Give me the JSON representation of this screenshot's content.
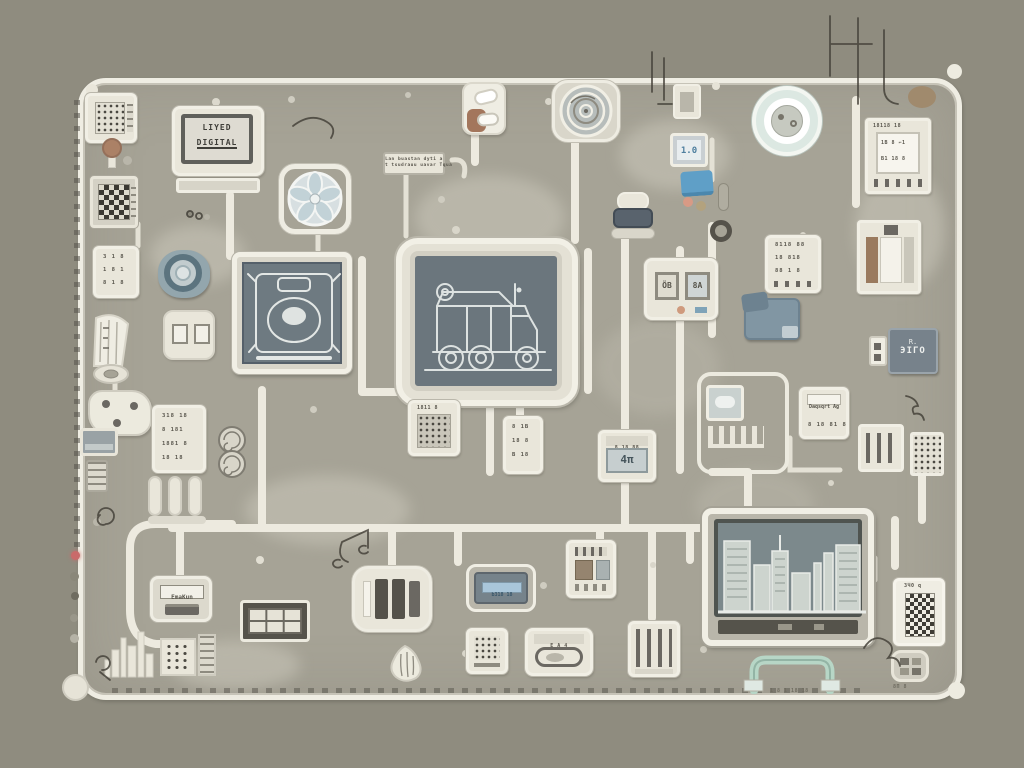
{
  "scene": {
    "title": "Stylized circuit board illustration with screens, chips and traces",
    "colors": {
      "background": "#8f8c7f",
      "board": "#a6a396",
      "trace": "#edeadf",
      "frame_white": "#f1efe5",
      "component_body": "#e9e6da",
      "bezel_gray": "#b9b6aa",
      "screen_slate": "#6e7a81",
      "ink": "#57544b",
      "accent_blue": "#5f9fc7",
      "accent_steel": "#8196a3",
      "accent_teal": "#5c747f",
      "accent_mint": "#b7d6c6",
      "accent_red": "#c96a6a",
      "accent_brown": "#a3765c",
      "accent_tan": "#a08a6d",
      "accent_salmon": "#d89a85"
    }
  },
  "texts": {
    "crt": {
      "line1": "LIYED",
      "line2": "DIGITAL"
    },
    "note": {
      "line1": "Lan buastan dyti a",
      "line2": "t tsudrauu uavar Tqua"
    },
    "mini_display": "1.0",
    "tr_chip": {
      "header": "18118 18",
      "row1": "1B 8 ⌐1",
      "row2": "B1 18 8"
    },
    "digits_chip": {
      "r0": "3 1 8",
      "r1": "1 8 1",
      "r2": "8 1 8"
    },
    "rows_left_chip": {
      "r0": "318 18",
      "r1": "8 181",
      "r2": "1881 8",
      "r3": "18 18"
    },
    "tall_chip": {
      "r0": "8 1B",
      "r1": "18 8",
      "r2": "B 18"
    },
    "grid_chip_label": "1811 8",
    "s461": {
      "header": "8 18 88",
      "value": "4π"
    },
    "dual_chip": {
      "w1": "ÖB",
      "w2": "8A"
    },
    "rows_right_chip": {
      "r0": "8118 88",
      "r1": "18 818",
      "r2": "88 1 8"
    },
    "ic_dark": {
      "line1": "R.",
      "line2": "ЭIГO"
    },
    "ag_chip": {
      "label": "Daqsqrt Ag",
      "digits": "8 18 81 8"
    },
    "emakun": "EmaKun",
    "bluescreen_label": "b318 18",
    "cassette_label": "E A 4",
    "qr_caption": "3Ч0 q",
    "connector_caption": "8П 8",
    "handle_caption": "1 8 1 18 18"
  }
}
